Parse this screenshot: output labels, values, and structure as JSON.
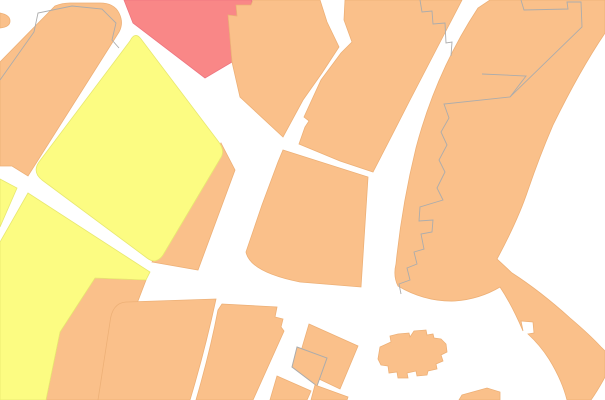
{
  "map": {
    "canvas": {
      "width": 605,
      "height": 400,
      "viewBox": "0 0 605 400"
    },
    "background": "#ffffff",
    "palette": {
      "orange": "#FAC08A",
      "orange_stroke": "#EDB077",
      "yellow": "#FCFC82",
      "yellow_stroke": "#E8E870",
      "red": "#F98787",
      "red_stroke": "#EE7580",
      "parcel_line": "#ACACAC",
      "street": "#FFFFFF"
    },
    "zones": [
      {
        "name": "top-left-block",
        "color": "orange",
        "d": "M0,62 L55,6 Q62,3 70,3 L100,3 Q114,3 119,13 Q124,23 119,32 L28,176 L12,166 L0,166 Z"
      },
      {
        "name": "left-edge-bump",
        "color": "orange",
        "d": "M0,13 Q10,15 10,21 Q10,27 0,28 Z"
      },
      {
        "name": "red-zone",
        "color": "red",
        "d": "M124,0 L252,0 L251,5 L236,5 L237,16 L228,15 L232,62 L205,78 L133,23 Z"
      },
      {
        "name": "top-center-block",
        "color": "orange",
        "d": "M253,0 L320,0 L327,22 L339,47 L322,73 L303,100 L283,137 L240,97 L232,62 L228,15 L237,16 L236,5 L251,5 Z"
      },
      {
        "name": "yellow-diamond-band",
        "color": "orange",
        "d": "M221,143 L235,170 L198,270 L152,262 Z"
      },
      {
        "name": "yellow-diamond",
        "color": "yellow",
        "d": "M141,39 L218,141 Q226,151 220,159 L163,255 Q156,265 147,258 L42,180 Q32,172 39,162 L130,41 Q135,31 141,39 Z"
      },
      {
        "name": "lower-yellow-band",
        "color": "orange",
        "d": "M95,278 L146,280 L100,400 L46,400 L60,332 Z"
      },
      {
        "name": "lower-yellow-block",
        "color": "yellow",
        "d": "M28,193 L150,272 L146,280 L95,278 L60,332 L46,400 L0,400 L0,242 Z"
      },
      {
        "name": "west-yellow-wedge",
        "color": "yellow",
        "d": "M0,179 L17,188 L0,227 Z"
      },
      {
        "name": "center-block",
        "color": "orange",
        "d": "M283,150 L368,177 L361,287 L300,282 Q250,272 246,252 L262,205 L278,162 Z"
      },
      {
        "name": "upper-center-block",
        "color": "orange",
        "d": "M345,0 L462,0 L436,50 L410,100 L388,143 L373,172 L340,161 L299,144 L305,127 L309,121 L304,117 L321,80 L341,53 L352,42 L344,20 Z"
      },
      {
        "name": "east-riverside-block",
        "color": "orange",
        "d": "M490,0 L605,0 L605,33 Q580,70 553,125 Q540,155 528,190 Q518,220 497,259 L512,273 Q540,291 570,318 Q590,335 601,347 L605,351 L605,377 Q598,390 591,400 L567,400 Q562,380 549,359 Q540,345 528,334 L534,333 L533,322 L521,321 L523,331 Q512,305 500,287 Q480,299 455,301 Q425,302 398,286 Q393,276 396,264 Q402,205 416,148 Q436,72 478,8 Z"
      },
      {
        "name": "south-block-west",
        "color": "orange",
        "d": "M216,299 Q205,350 190,400 L98,400 L110,322 Q112,303 126,302 Z"
      },
      {
        "name": "south-block-center",
        "color": "orange",
        "d": "M222,304 L277,307 L275,317 L283,319 L281,327 L284,331 L253,400 L196,400 Q210,352 218,310 Z"
      },
      {
        "name": "tilted-building",
        "color": "orange",
        "d": "M309,324 L358,346 L340,389 L296,368 Z"
      },
      {
        "name": "building-parcel",
        "color": "orange",
        "stroke": "parcel_line",
        "d": "M297,347 L327,358 L317,386 L292,367 Z"
      },
      {
        "name": "south-sliver-west",
        "color": "orange",
        "d": "M277,376 L311,391 L307,400 L270,400 Z"
      },
      {
        "name": "south-sliver-mid",
        "color": "orange",
        "d": "M315,385 L348,397 L347,400 L311,400 Z"
      },
      {
        "name": "church-building",
        "color": "orange",
        "d": "M378,359 L380,347 L391,342 L390,336 L398,334 L409,333 L410,337 L414,331 L426,330 L427,335 L433,334 L434,338 L441,339 L446,344 L447,352 L441,355 L443,361 L436,364 L437,369 L428,371 L427,375 L417,376 L416,371 L407,373 L408,378 L398,378 L397,372 L389,373 L388,366 L381,365 Z"
      },
      {
        "name": "south-sliver-east",
        "color": "orange",
        "d": "M459,400 L462,395 L487,388 L500,392 L500,400 Z"
      }
    ],
    "parcel_lines": [
      {
        "name": "parcel-topleft",
        "d": "M0,80 L34,32 L38,13 L72,6 L102,9 L116,23 L112,40 L119,48"
      },
      {
        "name": "parcel-steps-top",
        "d": "M420,0 L422,12 L432,11 L433,24 L445,23 L446,43 L452,42 L451,56"
      },
      {
        "name": "parcel-east-jagged",
        "d": "M521,0 L524,10 L568,9 L567,2 L581,2 L582,27 L510,97 L444,104 L449,118 L441,132 L447,145 L439,160 L445,172 L437,188 L443,200 L420,207 L419,221 L433,220 L432,232 L421,234 L424,249 L414,252 L417,264 L407,268 L410,280 L399,284 L401,294"
      },
      {
        "name": "parcel-east-spur",
        "d": "M510,97 L526,76 L482,74"
      }
    ]
  }
}
